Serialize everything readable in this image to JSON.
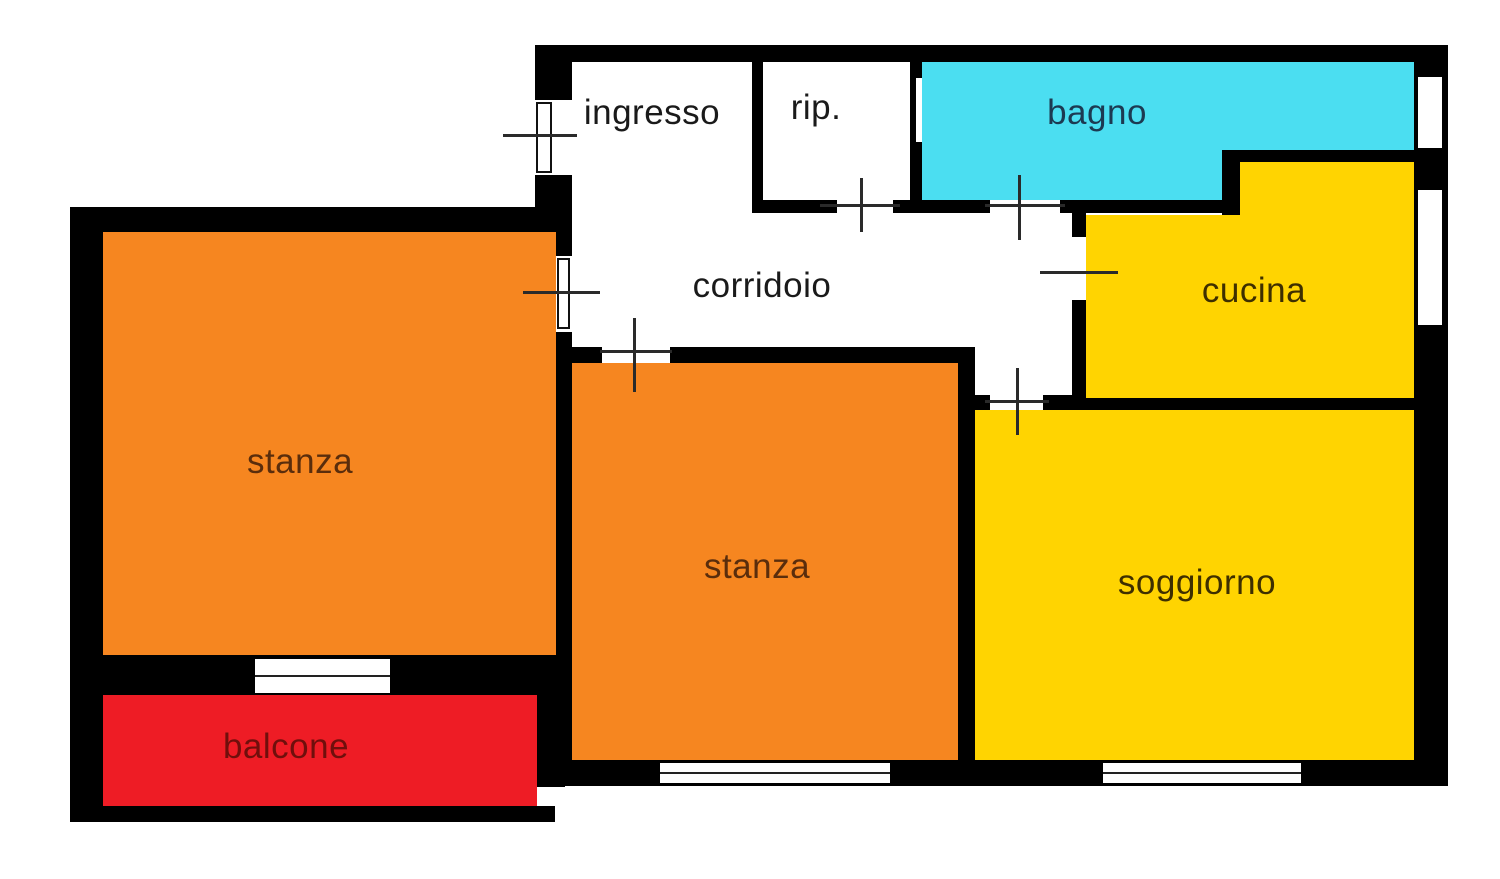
{
  "plan": {
    "title": "apartment floor plan",
    "canvas": {
      "width": 1500,
      "height": 879
    },
    "colors": {
      "background": "#ffffff",
      "wall": "#000000",
      "marker_line": "#2a2a2a",
      "orange_room": "#F68620",
      "yellow_room": "#FFD401",
      "cyan_room": "#4BDEF1",
      "red_room": "#EE1C25"
    },
    "rooms": [
      {
        "id": "ingresso",
        "label": "ingresso",
        "fill": "none",
        "label_color": "#1a1a1a",
        "label_x": 652,
        "label_y": 113,
        "rects": []
      },
      {
        "id": "rip",
        "label": "rip.",
        "fill": "none",
        "label_color": "#1a1a1a",
        "label_x": 816,
        "label_y": 108,
        "rects": []
      },
      {
        "id": "bagno",
        "label": "bagno",
        "fill": "#4BDEF1",
        "label_color": "#1C3A52",
        "label_x": 1097,
        "label_y": 113,
        "rects": [
          [
            922,
            62,
            492,
            88
          ],
          [
            922,
            150,
            300,
            50
          ]
        ]
      },
      {
        "id": "cucina",
        "label": "cucina",
        "fill": "#FFD401",
        "label_color": "#3E2F00",
        "label_x": 1254,
        "label_y": 291,
        "rects": [
          [
            1240,
            162,
            174,
            53
          ],
          [
            1086,
            215,
            328,
            183
          ]
        ]
      },
      {
        "id": "corridoio",
        "label": "corridoio",
        "fill": "none",
        "label_color": "#1a1a1a",
        "label_x": 762,
        "label_y": 286,
        "rects": []
      },
      {
        "id": "stanza-sx",
        "label": "stanza",
        "fill": "#F68620",
        "label_color": "#5A2D0C",
        "label_x": 300,
        "label_y": 462,
        "rects": [
          [
            103,
            232,
            453,
            423
          ]
        ]
      },
      {
        "id": "stanza-centro",
        "label": "stanza",
        "fill": "#F68620",
        "label_color": "#5A2D0C",
        "label_x": 757,
        "label_y": 567,
        "rects": [
          [
            572,
            363,
            386,
            397
          ]
        ]
      },
      {
        "id": "soggiorno",
        "label": "soggiorno",
        "fill": "#FFD401",
        "label_color": "#3E2F00",
        "label_x": 1197,
        "label_y": 583,
        "rects": [
          [
            975,
            410,
            439,
            350
          ]
        ]
      },
      {
        "id": "balcone",
        "label": "balcone",
        "fill": "#EE1C25",
        "label_color": "#700F0C",
        "label_x": 286,
        "label_y": 747,
        "rects": [
          [
            103,
            695,
            434,
            111
          ]
        ]
      }
    ],
    "walls": [
      [
        535,
        45,
        913,
        17
      ],
      [
        1414,
        45,
        34,
        741
      ],
      [
        553,
        760,
        895,
        26
      ],
      [
        535,
        45,
        37,
        170
      ],
      [
        752,
        45,
        11,
        168
      ],
      [
        910,
        45,
        12,
        168
      ],
      [
        752,
        200,
        488,
        13
      ],
      [
        1222,
        148,
        18,
        67
      ],
      [
        1228,
        148,
        190,
        14
      ],
      [
        1072,
        212,
        14,
        186
      ],
      [
        553,
        347,
        422,
        16
      ],
      [
        958,
        347,
        17,
        413
      ],
      [
        958,
        395,
        460,
        15
      ],
      [
        70,
        207,
        502,
        25
      ],
      [
        70,
        207,
        33,
        615
      ],
      [
        556,
        207,
        16,
        553
      ],
      [
        70,
        655,
        502,
        40
      ],
      [
        70,
        806,
        485,
        16
      ],
      [
        537,
        695,
        28,
        92
      ],
      [
        965,
        45,
        45,
        33
      ],
      [
        1395,
        58,
        25,
        32
      ],
      [
        972,
        652,
        38,
        53
      ]
    ],
    "door_gaps": [
      [
        535,
        100,
        37,
        75
      ],
      [
        837,
        200,
        56,
        13
      ],
      [
        990,
        200,
        70,
        13
      ],
      [
        1072,
        237,
        14,
        63
      ],
      [
        556,
        256,
        16,
        76
      ],
      [
        602,
        347,
        68,
        16
      ],
      [
        990,
        395,
        53,
        15
      ],
      [
        916,
        78,
        6,
        64
      ]
    ],
    "door_leaves": [
      [
        536,
        102,
        16,
        71
      ],
      [
        557,
        258,
        13,
        71
      ]
    ],
    "door_h_lines": [
      [
        503,
        134,
        74
      ],
      [
        820,
        204,
        80
      ],
      [
        985,
        204,
        80
      ],
      [
        1040,
        271,
        78
      ],
      [
        523,
        291,
        77
      ],
      [
        600,
        350,
        72
      ],
      [
        985,
        400,
        64
      ]
    ],
    "door_v_lines": [
      [
        860,
        178,
        54
      ],
      [
        1018,
        175,
        65
      ],
      [
        633,
        318,
        74
      ],
      [
        1016,
        368,
        67
      ]
    ],
    "windows": [
      {
        "rect": [
          255,
          659,
          135,
          34
        ],
        "mid": true
      },
      {
        "rect": [
          660,
          763,
          230,
          20
        ],
        "mid": true
      },
      {
        "rect": [
          1103,
          763,
          198,
          20
        ],
        "mid": true
      },
      {
        "rect": [
          1418,
          77,
          24,
          71
        ],
        "mid": false
      },
      {
        "rect": [
          1418,
          190,
          24,
          135
        ],
        "mid": false
      }
    ]
  }
}
